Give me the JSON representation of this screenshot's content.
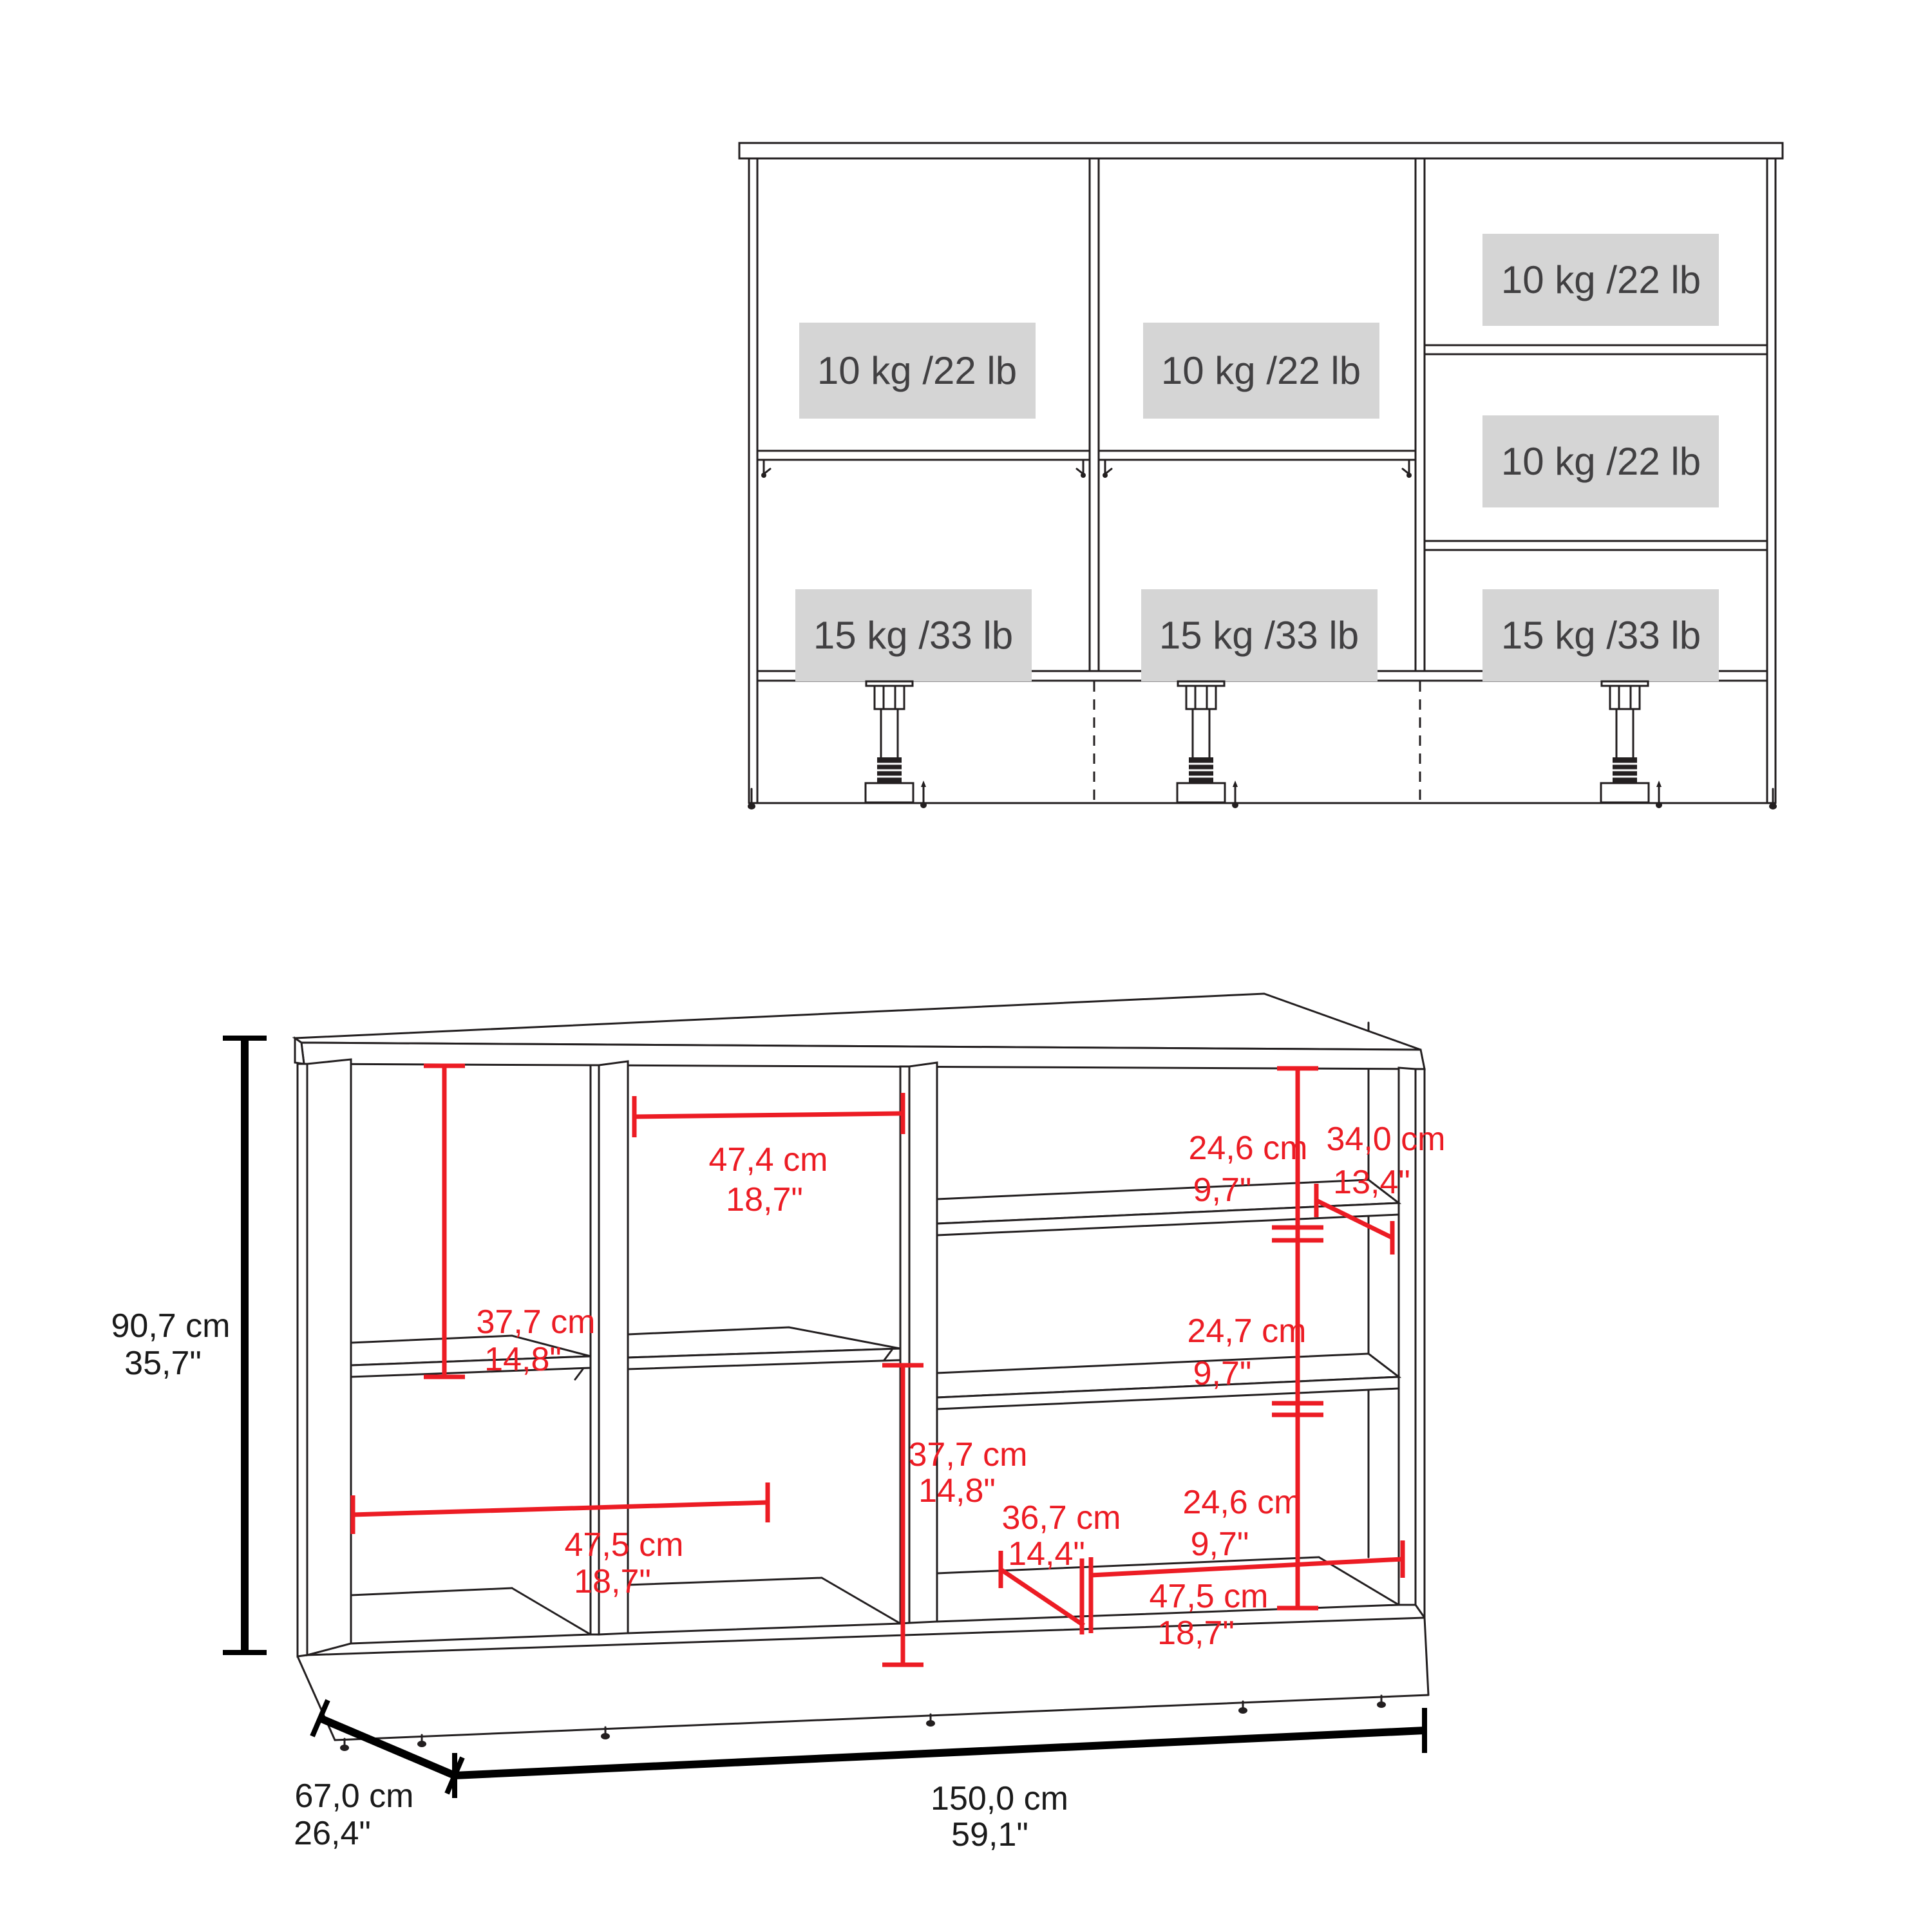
{
  "colors": {
    "background": "#ffffff",
    "line": "#231f20",
    "dimension_red": "#ec1c24",
    "dimension_black": "#000000",
    "capacity_box_fill": "#d5d5d5",
    "capacity_text": "#414042"
  },
  "front_view": {
    "capacity_small": "10 kg /22 lb",
    "capacity_large": "15 kg /33 lb",
    "compartments": [
      {
        "position": "left-upper",
        "capacity": "10 kg /22 lb"
      },
      {
        "position": "middle-upper",
        "capacity": "10 kg /22 lb"
      },
      {
        "position": "right-top",
        "capacity": "10 kg /22 lb"
      },
      {
        "position": "right-middle",
        "capacity": "10 kg /22 lb"
      },
      {
        "position": "left-lower",
        "capacity": "15 kg /33 lb"
      },
      {
        "position": "middle-lower",
        "capacity": "15 kg /33 lb"
      },
      {
        "position": "right-bottom",
        "capacity": "15 kg /33 lb"
      }
    ]
  },
  "iso_view": {
    "height_cm": "90,7 cm",
    "height_in": "35,7\"",
    "depth_cm": "67,0 cm",
    "depth_in": "26,4\"",
    "width_cm": "150,0 cm",
    "width_in": "59,1\"",
    "left_upper_cm": "37,7 cm",
    "left_upper_in": "14,8\"",
    "mid_top_cm": "47,4 cm",
    "mid_top_in": "18,7\"",
    "right_top_cm": "24,6 cm",
    "right_top_in": "9,7\"",
    "right_depth_cm": "34,0 cm",
    "right_depth_in": "13,4\"",
    "right_mid_cm": "24,7 cm",
    "right_mid_in": "9,7\"",
    "right_bottom_cm": "24,6 cm",
    "right_bottom_in": "9,7\"",
    "mid_lower_cm": "37,7 cm",
    "mid_lower_in": "14,8\"",
    "mid_depth_cm": "36,7 cm",
    "mid_depth_in": "14,4\"",
    "left_bottom_cm": "47,5 cm",
    "left_bottom_in": "18,7\"",
    "right_width_cm": "47,5 cm",
    "right_width_in": "18,7\""
  }
}
